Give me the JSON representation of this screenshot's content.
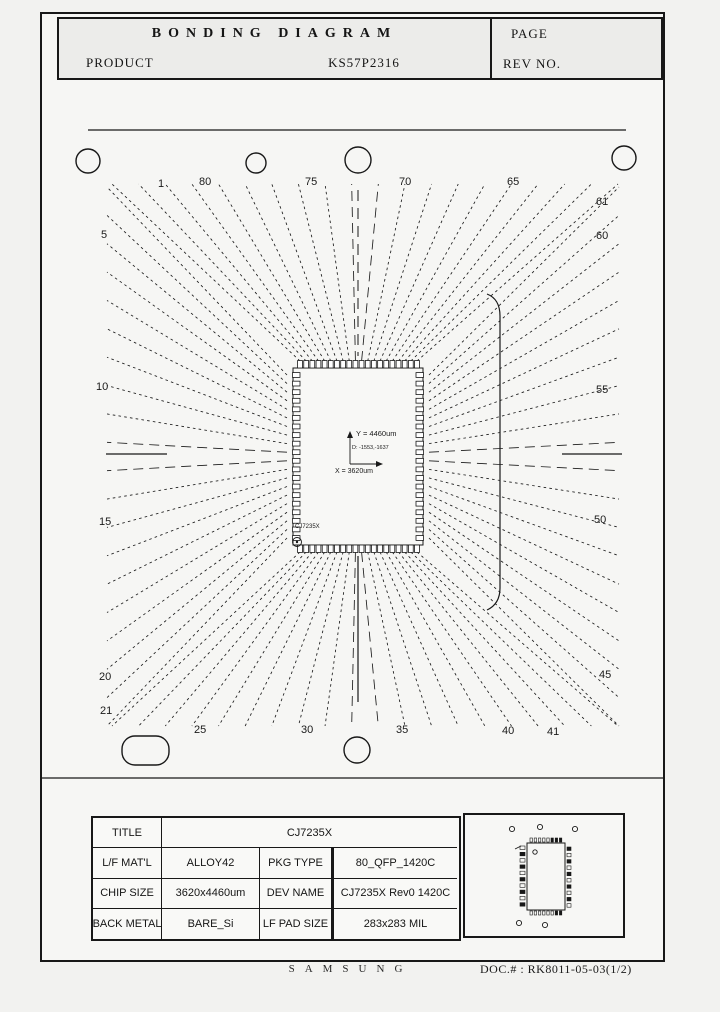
{
  "header": {
    "title": "BONDING DIAGRAM",
    "product_label": "PRODUCT",
    "product_value": "KS57P2316",
    "page_label": "PAGE",
    "rev_label": "REV NO."
  },
  "diagram": {
    "chip_label": "CJ7235X",
    "annotations": {
      "y_dim": "Y = 4460um",
      "d_ref": "D: -1553,-1637",
      "x_dim": "X = 3620um"
    },
    "pin_labels": [
      {
        "t": "1",
        "x": 158,
        "y": 178
      },
      {
        "t": "80",
        "x": 199,
        "y": 176
      },
      {
        "t": "75",
        "x": 305,
        "y": 176
      },
      {
        "t": "70",
        "x": 399,
        "y": 176
      },
      {
        "t": "65",
        "x": 507,
        "y": 176
      },
      {
        "t": "61",
        "x": 596,
        "y": 196
      },
      {
        "t": "60",
        "x": 596,
        "y": 230
      },
      {
        "t": "55",
        "x": 596,
        "y": 384
      },
      {
        "t": "50",
        "x": 594,
        "y": 514
      },
      {
        "t": "45",
        "x": 599,
        "y": 669
      },
      {
        "t": "41",
        "x": 547,
        "y": 726
      },
      {
        "t": "40",
        "x": 502,
        "y": 725
      },
      {
        "t": "35",
        "x": 396,
        "y": 724
      },
      {
        "t": "30",
        "x": 301,
        "y": 724
      },
      {
        "t": "25",
        "x": 194,
        "y": 724
      },
      {
        "t": "21",
        "x": 100,
        "y": 705
      },
      {
        "t": "20",
        "x": 99,
        "y": 671
      },
      {
        "t": "15",
        "x": 99,
        "y": 516
      },
      {
        "t": "10",
        "x": 96,
        "y": 381
      },
      {
        "t": "5",
        "x": 101,
        "y": 229
      }
    ]
  },
  "info_table": {
    "rows": [
      {
        "label": "TITLE",
        "v1": "CJ7235X"
      },
      {
        "label": "L/F MAT'L",
        "v1": "ALLOY42",
        "k2": "PKG TYPE",
        "v2": "80_QFP_1420C"
      },
      {
        "label": "CHIP SIZE",
        "v1": "3620x4460um",
        "k2": "DEV NAME",
        "v2": "CJ7235X  Rev0  1420C"
      },
      {
        "label": "BACK METAL",
        "v1": "BARE_Si",
        "k2": "LF PAD SIZE",
        "v2": "283x283 MIL"
      }
    ]
  },
  "footer": {
    "brand": "SAMSUNG",
    "doc_no": "DOC.# : RK8011-05-03(1/2)"
  }
}
